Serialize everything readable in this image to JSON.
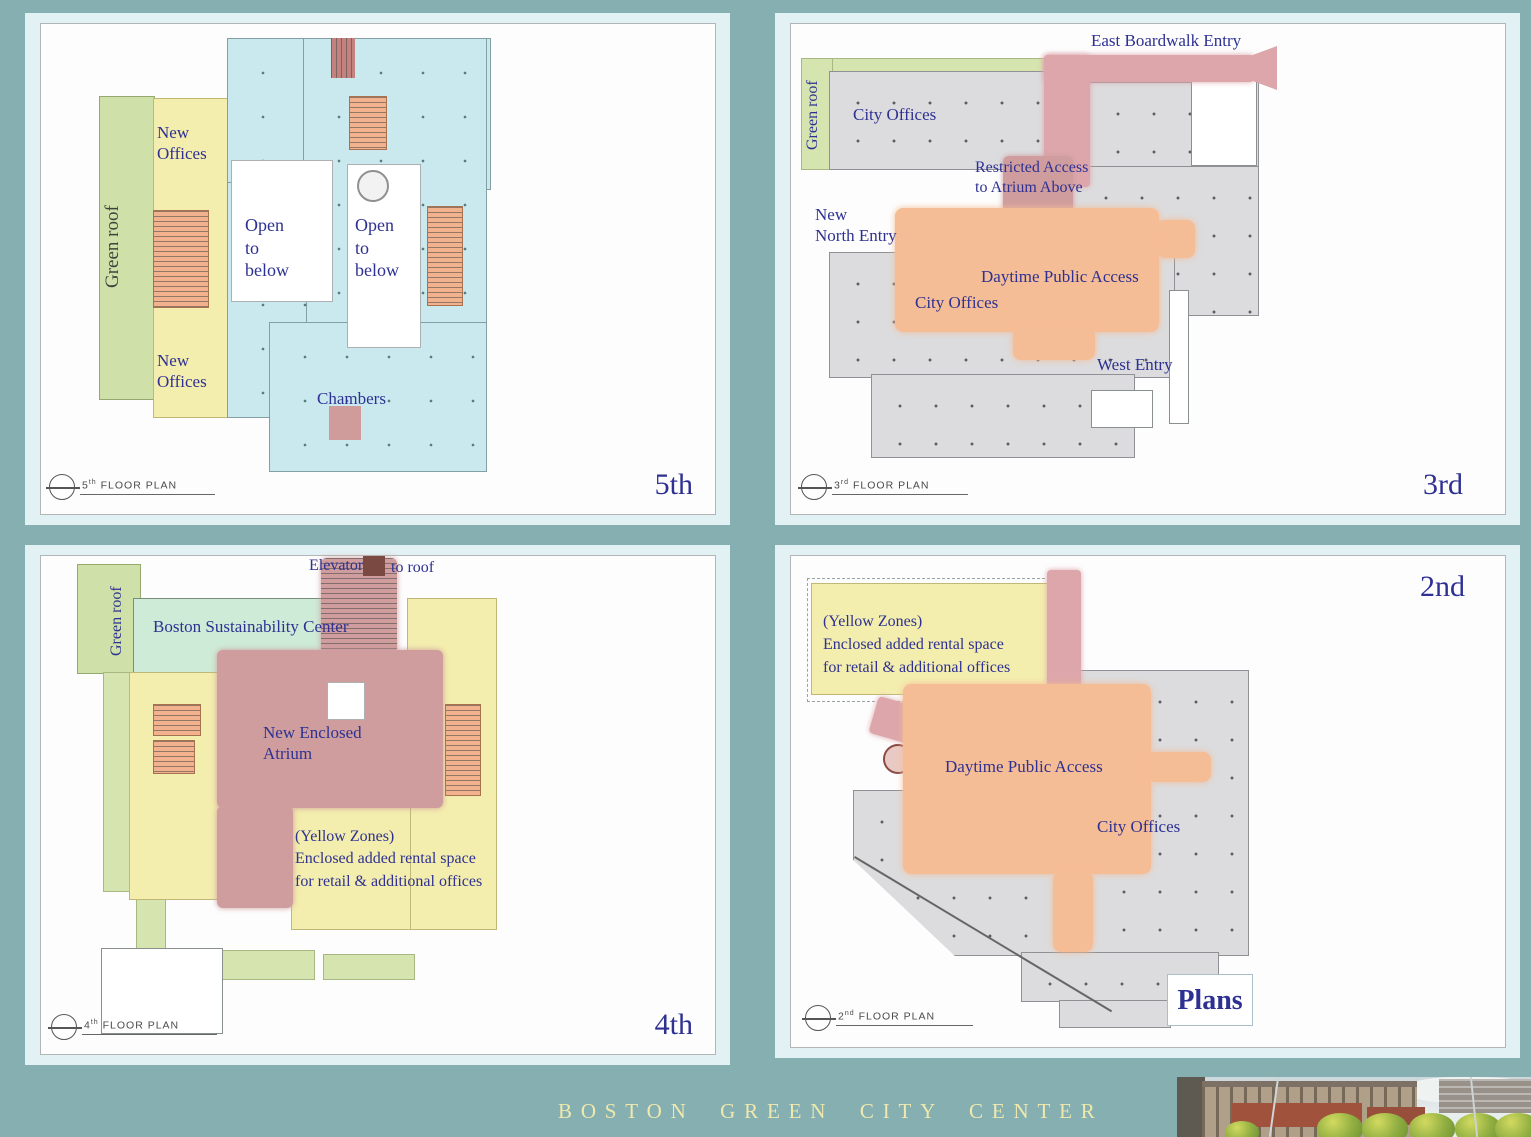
{
  "title_bar": {
    "text": "BOSTON GREEN CITY CENTER"
  },
  "panels": {
    "p5": {
      "floor": "5th",
      "stamp": {
        "num": "5",
        "ord": "th",
        "text": "FLOOR PLAN"
      },
      "labels": {
        "green_roof": "Green roof",
        "new_offices_top": "New\nOffices",
        "new_offices_bottom": "New\nOffices",
        "open_left": "Open\nto\nbelow",
        "open_right": "Open\nto\nbelow",
        "chambers": "Chambers"
      }
    },
    "p3": {
      "floor": "3rd",
      "stamp": {
        "num": "3",
        "ord": "rd",
        "text": "FLOOR PLAN"
      },
      "labels": {
        "east_boardwalk": "East Boardwalk Entry",
        "green_roof": "Green roof",
        "city_offices_top": "City Offices",
        "restricted": "Restricted Access\nto Atrium Above",
        "new_north": "New\nNorth Entry",
        "daytime": "Daytime Public Access",
        "city_offices_bottom": "City Offices",
        "west_entry": "West Entry"
      }
    },
    "p4": {
      "floor": "4th",
      "stamp": {
        "num": "4",
        "ord": "th",
        "text": "FLOOR PLAN"
      },
      "labels": {
        "elevator": "Elevator",
        "to_roof": "to roof",
        "green_roof": "Green roof",
        "sustainability": "Boston  Sustainability Center",
        "atrium": "New Enclosed\nAtrium",
        "yellow_note": "(Yellow Zones)\nEnclosed added rental space\nfor  retail & additional offices"
      }
    },
    "p2": {
      "floor": "2nd",
      "stamp": {
        "num": "2",
        "ord": "nd",
        "text": "FLOOR PLAN"
      },
      "labels": {
        "yellow_note": "(Yellow Zones)\nEnclosed added rental space\nfor  retail & additional offices",
        "daytime": "Daytime Public Access",
        "city_offices": "City Offices",
        "plans": "Plans"
      }
    }
  },
  "colors": {
    "background_teal": "#85afb1",
    "card_cyan": "#e2f1f4",
    "plan_cyan": "#c9e9ef",
    "zone_yellow": "#f3edae",
    "zone_green": "#cfe0a8",
    "zone_mint": "#cdebd6",
    "zone_orange": "#f5bd96",
    "zone_rose": "#cf9d9d",
    "zone_gray": "#dcdcde",
    "label_navy": "#2e3192",
    "title_yellow": "#efe9ad"
  }
}
